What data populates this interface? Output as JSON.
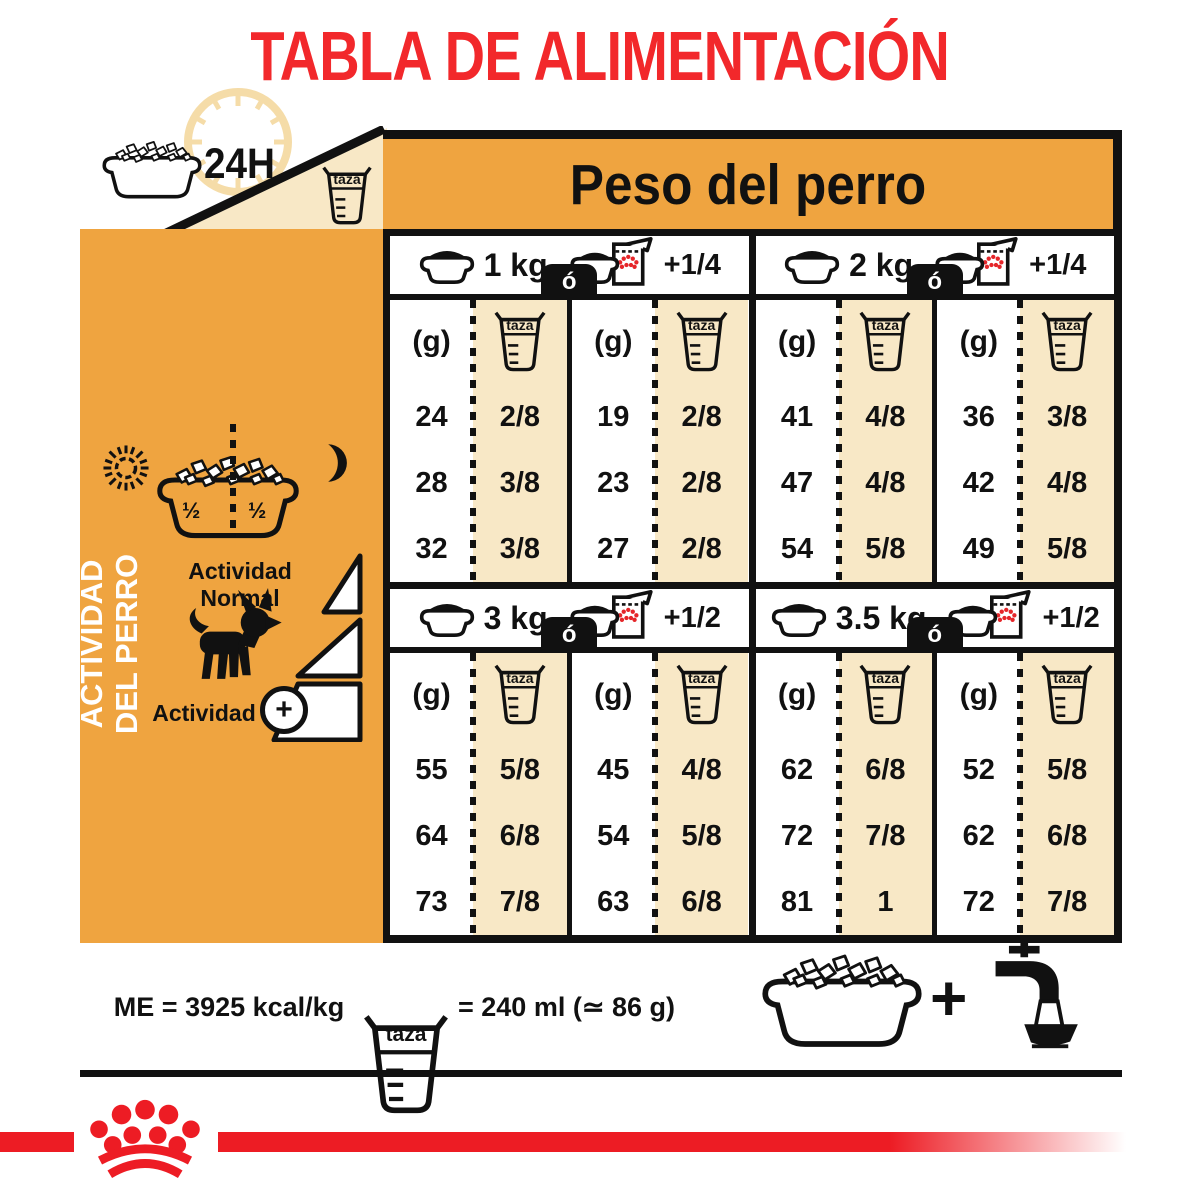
{
  "title": "TABLA DE ALIMENTACIÓN",
  "header": {
    "hours": "24H",
    "weight_band": "Peso del perro",
    "cup_label": "taza"
  },
  "sidebar": {
    "vertical_label_line1": "ACTIVIDAD",
    "vertical_label_line2": "DEL PERRO",
    "bowl_halves": [
      "½",
      "½"
    ],
    "activity_normal": "Actividad Normal",
    "activity": "Actividad",
    "activity_plus": "+"
  },
  "table": {
    "or_label": "ó",
    "grams_header": "(g)",
    "cup_header": "taza",
    "blocks": [
      {
        "groups": [
          {
            "weight": "1 kg",
            "wet_add": "+1/4",
            "dry": {
              "g": [
                "24",
                "28",
                "32"
              ],
              "cups": [
                "2/8",
                "3/8",
                "3/8"
              ]
            },
            "mixed": {
              "g": [
                "19",
                "23",
                "27"
              ],
              "cups": [
                "2/8",
                "2/8",
                "2/8"
              ]
            }
          },
          {
            "weight": "2 kg",
            "wet_add": "+1/4",
            "dry": {
              "g": [
                "41",
                "47",
                "54"
              ],
              "cups": [
                "4/8",
                "4/8",
                "5/8"
              ]
            },
            "mixed": {
              "g": [
                "36",
                "42",
                "49"
              ],
              "cups": [
                "3/8",
                "4/8",
                "5/8"
              ]
            }
          }
        ]
      },
      {
        "groups": [
          {
            "weight": "3 kg",
            "wet_add": "+1/2",
            "dry": {
              "g": [
                "55",
                "64",
                "73"
              ],
              "cups": [
                "5/8",
                "6/8",
                "7/8"
              ]
            },
            "mixed": {
              "g": [
                "45",
                "54",
                "63"
              ],
              "cups": [
                "4/8",
                "5/8",
                "6/8"
              ]
            }
          },
          {
            "weight": "3.5 kg",
            "wet_add": "+1/2",
            "dry": {
              "g": [
                "62",
                "72",
                "81"
              ],
              "cups": [
                "6/8",
                "7/8",
                "1"
              ]
            },
            "mixed": {
              "g": [
                "52",
                "62",
                "72"
              ],
              "cups": [
                "5/8",
                "6/8",
                "7/8"
              ]
            }
          }
        ]
      }
    ]
  },
  "footer": {
    "me": "ME = 3925 kcal/kg",
    "cup_label": "taza",
    "cup_equiv": "= 240 ml (≃ 86 g)",
    "plus": "+"
  },
  "colors": {
    "gold": "#EFA440",
    "beige": "#F8E8C6",
    "clock_tan": "#F5DCA8",
    "red": "#ED1C24",
    "title_red": "#F2282B",
    "black": "#111111"
  }
}
